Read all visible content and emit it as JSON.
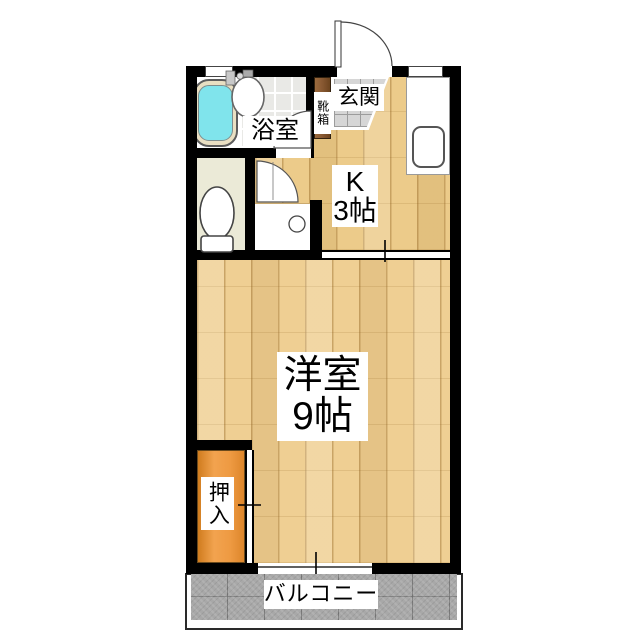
{
  "rooms": {
    "bathroom": {
      "label": "浴室"
    },
    "entrance": {
      "label": "玄関"
    },
    "shoe_cabinet": {
      "label": "靴箱"
    },
    "kitchen": {
      "label": "K",
      "size": "3帖"
    },
    "western_room": {
      "label": "洋室",
      "size": "9帖"
    },
    "closet": {
      "label": "押入"
    },
    "balcony": {
      "label": "バルコニー"
    }
  },
  "colors": {
    "wall": "#000000",
    "wood_floor": "#efcf93",
    "kitchen_floor": "#eccb8a",
    "tub_water": "#80e4ec",
    "tub_rim": "#e9dfc2",
    "bath_tile": "#e9e9e6",
    "toilet_floor": "#ebead7",
    "entrance_tile": "#d6d6d6",
    "shoe_cabinet": "#8a5a33",
    "closet": "#ee9a42",
    "balcony": "#a8a8a8",
    "fixture_outline": "#555555"
  }
}
